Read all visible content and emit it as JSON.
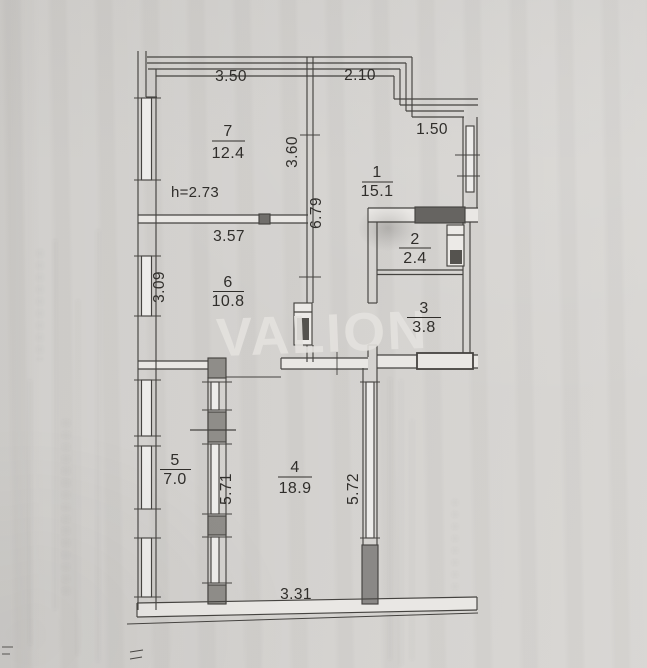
{
  "watermark": {
    "text": "VALION"
  },
  "notes": {
    "ceiling_height": "h=2.73"
  },
  "rooms": [
    {
      "number": "1",
      "area": "15.1"
    },
    {
      "number": "2",
      "area": "2.4"
    },
    {
      "number": "3",
      "area": "3.8"
    },
    {
      "number": "4",
      "area": "18.9"
    },
    {
      "number": "5",
      "area": "7.0"
    },
    {
      "number": "6",
      "area": "10.8"
    },
    {
      "number": "7",
      "area": "12.4"
    }
  ],
  "dimensions": {
    "top_left_width": "3.50",
    "top_right_width": "2.10",
    "right_top_width": "1.50",
    "hall_upper_height": "3.60",
    "hall_height": "6.79",
    "room6_width": "3.57",
    "room6_left_height": "3.09",
    "room5_right_height": "5.71",
    "room4_right_height": "5.72",
    "bottom_width": "3.31"
  },
  "colors": {
    "paper": "#d3d1ce",
    "ink": "#454340",
    "watermark": "#e4e2de"
  }
}
